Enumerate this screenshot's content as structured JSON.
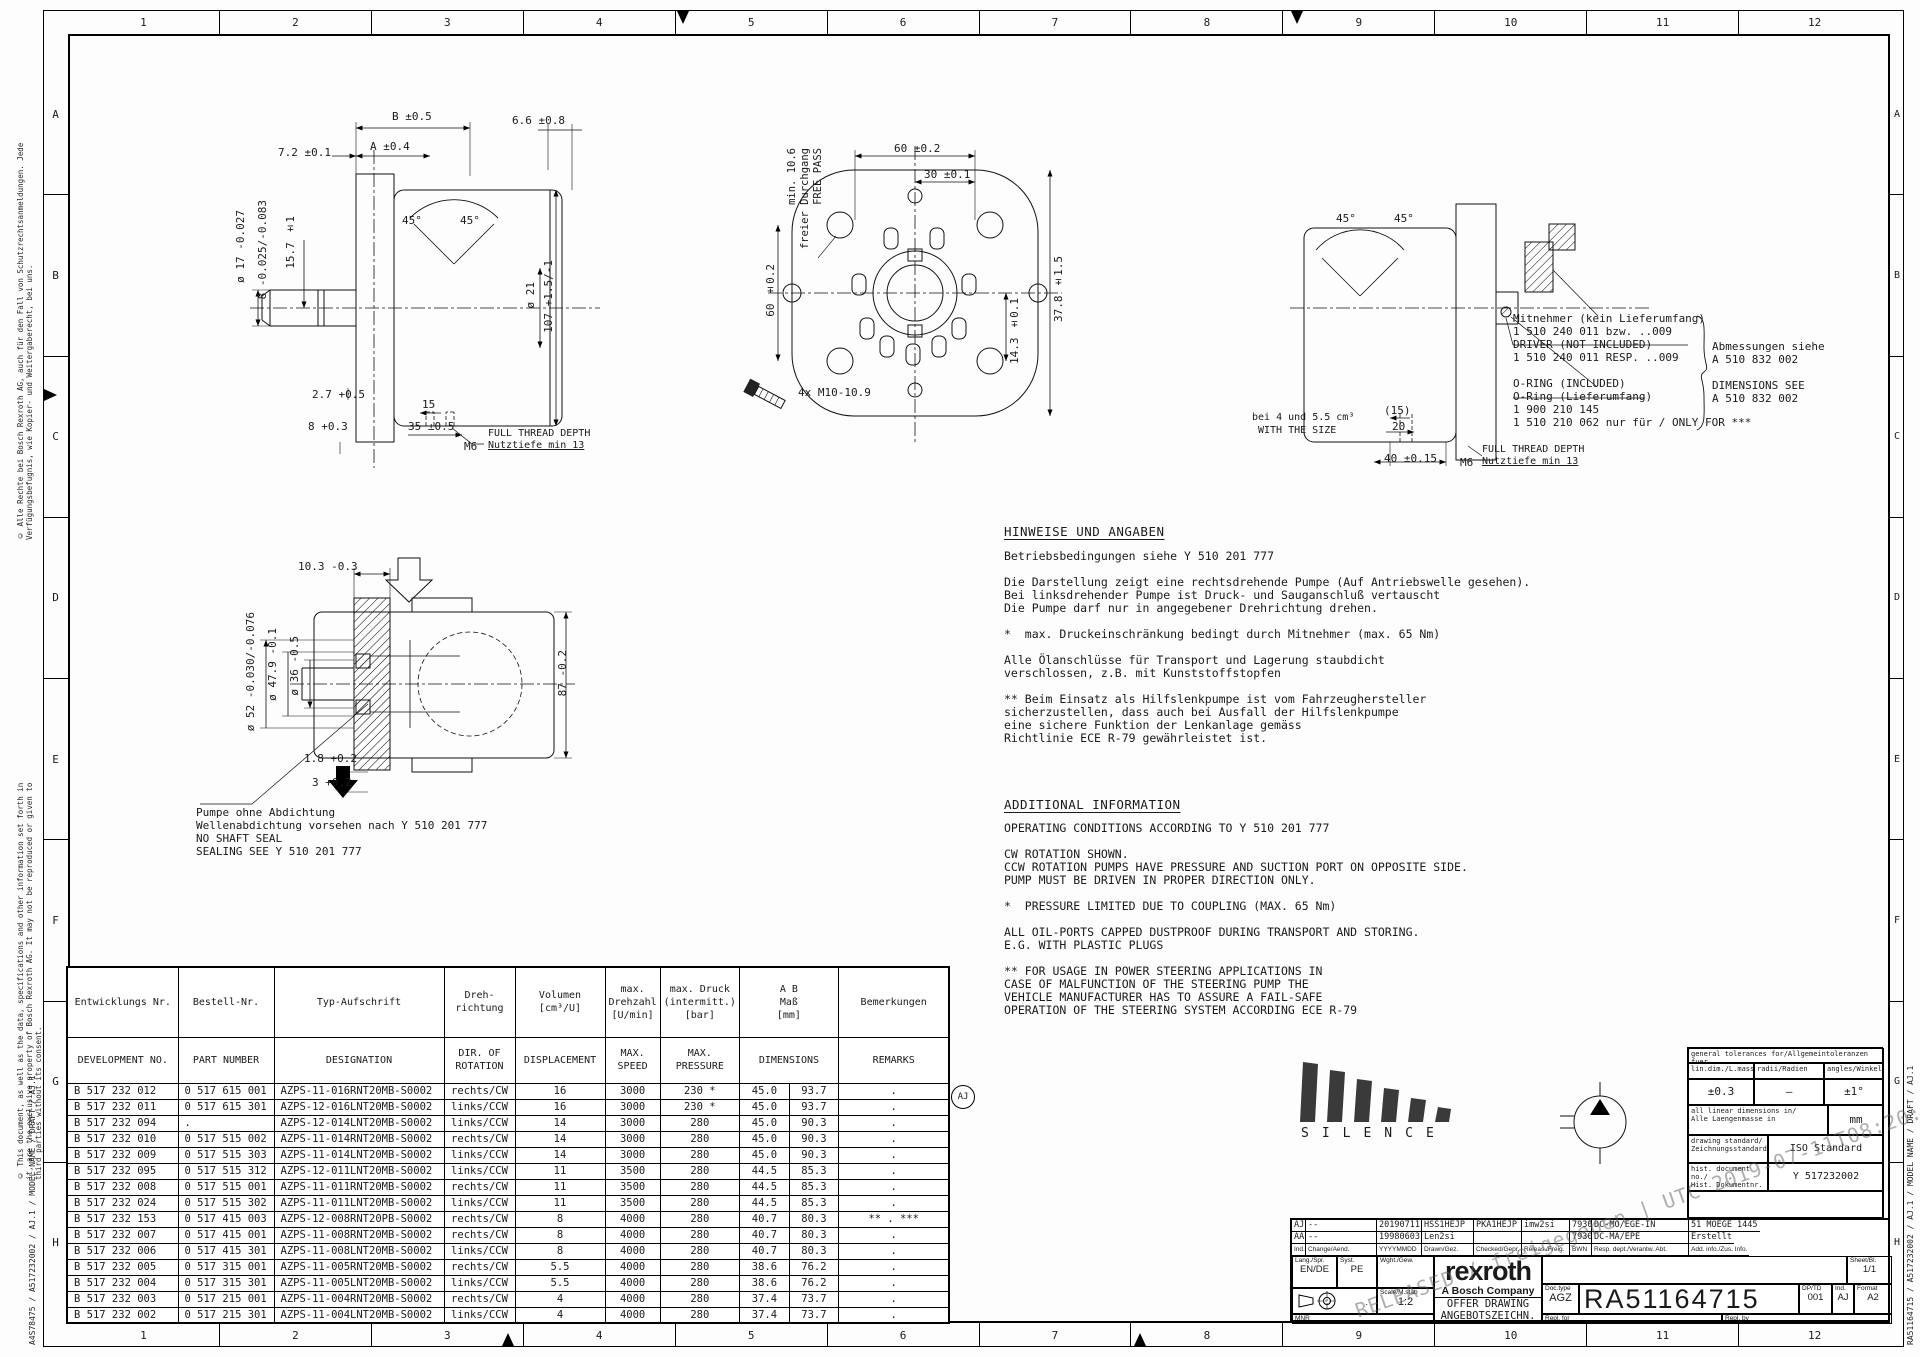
{
  "frame": {
    "columns": [
      "1",
      "2",
      "3",
      "4",
      "5",
      "6",
      "7",
      "8",
      "9",
      "10",
      "11",
      "12"
    ],
    "rows": [
      "A",
      "B",
      "C",
      "D",
      "E",
      "F",
      "G",
      "H"
    ]
  },
  "margin": {
    "copyright_de": "© Alle Rechte bei Bosch Rexroth AG, auch für den Fall von Schutzrechtsanmeldungen. Jede Verfügungsbefugnis, wie Kopier- und Weitergaberecht, bei uns.",
    "copyright_en": "© This document, as well as the data, specifications and other information set forth in it, are the exclusive property of Bosch Rexroth AG. It may not be reproduced or given to third parties without its consent.",
    "left_code": "A4S78475 / A517232002 / AJ.1 / MODEL NAME / DRAFT / AJ.1",
    "right_code": "RA51164715 / A517232002 / AJ.1 / MODEL NAME / DRAFT / AJ.1"
  },
  "dims": {
    "v1_72": "7.2 ±0.1",
    "v1_b": "B ±0.5",
    "v1_66": "6.6 ±0.8",
    "v1_a": "A ±0.4",
    "v1_d17": "ø 17 -0.027",
    "v1_8tol": "8 -0.025/-0.083",
    "v1_157": "15.7 ±1",
    "v1_45a": "45°",
    "v1_45b": "45°",
    "v1_d21": "ø 21",
    "v1_107": "107 +1.5/-1",
    "v1_27": "2.7 +0.5",
    "v1_8": "8 +0.3",
    "v1_15": "15",
    "v1_35": "35 ±0.5",
    "v1_m6": "M6",
    "v1_thread_en": "FULL THREAD DEPTH",
    "v1_thread_de": "Nutztiefe min 13",
    "v2_free1": "min. 10.6",
    "v2_free2": "freier Durchgang",
    "v2_free3": "FREE PASS",
    "v2_60t": "60 ±0.2",
    "v2_30": "30 ±0.1",
    "v2_378": "37.8 ±1.5",
    "v2_60l": "60 ±0.2",
    "v2_143": "14.3 ±0.1",
    "v2_screws": "4x M10-10.9",
    "v3_45a": "45°",
    "v3_45b": "45°",
    "v3_size1": "bei 4 und 5.5 cm³",
    "v3_size2": "WITH THE SIZE",
    "v3_15": "(15)",
    "v3_20": "20",
    "v3_40": "40 ±0.15",
    "v3_m6": "M6",
    "v3_thread_en": "FULL THREAD DEPTH",
    "v3_thread_de": "Nutztiefe min 13",
    "v4_103": "10.3 -0.3",
    "v4_d52": "ø 52 -0.030/-0.076",
    "v4_d479": "ø 47.9 -0.1",
    "v4_d36": "ø 36 -0.5",
    "v4_87": "87 -0.2",
    "v4_18": "1.8 +0.2",
    "v4_3": "3 +0.2"
  },
  "notes": {
    "driver_block": [
      "Mitnehmer (kein Lieferumfang)",
      "1 510 240 011 bzw. ..009",
      "DRIVER (NOT INCLUDED)",
      "1 510 240 011 RESP. ..009",
      "",
      "O-RING (INCLUDED)",
      "O-Ring (Lieferumfang)",
      "1 900 210 145",
      "1 510 210 062 nur für / ONLY FOR ***"
    ],
    "dimensions_block": [
      "Abmessungen siehe",
      "A 510 832 002",
      "",
      "DIMENSIONS SEE",
      "A 510 832 002"
    ],
    "seal_block": [
      "Pumpe ohne Abdichtung",
      "Wellenabdichtung vorsehen nach Y 510 201 777",
      "NO SHAFT SEAL",
      "SEALING SEE Y 510 201 777"
    ],
    "hinweise_heading": "HINWEISE UND ANGABEN",
    "hinweise_lines": [
      "Betriebsbedingungen siehe Y 510 201 777",
      "",
      "Die Darstellung zeigt eine rechtsdrehende Pumpe (Auf Antriebswelle gesehen).",
      "Bei linksdrehender Pumpe ist Druck- und Sauganschluß vertauscht",
      "Die Pumpe darf nur in angegebener Drehrichtung drehen.",
      "",
      "*  max. Druckeinschränkung bedingt durch Mitnehmer (max. 65 Nm)",
      "",
      "Alle Ölanschlüsse für Transport und Lagerung staubdicht",
      "verschlossen, z.B. mit Kunststoffstopfen",
      "",
      "** Beim Einsatz als Hilfslenkpumpe ist vom Fahrzeughersteller",
      "sicherzustellen, dass auch bei Ausfall der Hilfslenkpumpe",
      "eine sichere Funktion der Lenkanlage gemäss",
      "Richtlinie ECE R-79 gewährleistet ist."
    ],
    "additional_heading": "ADDITIONAL INFORMATION",
    "additional_lines": [
      "OPERATING CONDITIONS ACCORDING TO Y 510 201 777",
      "",
      "CW ROTATION SHOWN.",
      "CCW ROTATION PUMPS HAVE PRESSURE AND SUCTION PORT ON OPPOSITE SIDE.",
      "PUMP MUST BE DRIVEN IN PROPER DIRECTION ONLY.",
      "",
      "*  PRESSURE LIMITED DUE TO COUPLING (MAX. 65 Nm)",
      "",
      "ALL OIL-PORTS CAPPED DUSTPROOF DURING TRANSPORT AND STORING.",
      "E.G. WITH PLASTIC PLUGS",
      "",
      "** FOR USAGE IN POWER STEERING APPLICATIONS IN",
      "CASE OF MALFUNCTION OF THE STEERING PUMP THE",
      "VEHICLE MANUFACTURER HAS TO ASSURE A FAIL-SAFE",
      "OPERATION OF THE STEERING SYSTEM ACCORDING ECE R-79"
    ]
  },
  "parts_table": {
    "header_de": {
      "dev": "Entwicklungs Nr.",
      "part": "Bestell-Nr.",
      "desig": "Typ-Aufschrift",
      "rot": "Dreh-\nrichtung",
      "disp": "Volumen\n[cm³/U]",
      "speed": "max.\nDrehzahl\n[U/min]",
      "press": "max. Druck\n(intermitt.)\n[bar]",
      "dims": "A        B\nMaß\n[mm]",
      "rem": "Bemerkungen"
    },
    "header_en": {
      "dev": "DEVELOPMENT NO.",
      "part": "PART NUMBER",
      "desig": "DESIGNATION",
      "rot": "DIR. OF\nROTATION",
      "disp": "DISPLACEMENT",
      "speed": "MAX.\nSPEED",
      "press": "MAX.\nPRESSURE",
      "dims": "DIMENSIONS",
      "rem": "REMARKS"
    },
    "rows": [
      {
        "dev": "B 517 232 012",
        "part": "0 517 615 001",
        "desig": "AZPS-11-016RNT20MB-S0002",
        "rot": "rechts/CW",
        "disp": "16",
        "speed": "3000",
        "press": "230 *",
        "a": "45.0",
        "b": "93.7",
        "rem": "."
      },
      {
        "dev": "B 517 232 011",
        "part": "0 517 615 301",
        "desig": "AZPS-12-016LNT20MB-S0002",
        "rot": "links/CCW",
        "disp": "16",
        "speed": "3000",
        "press": "230 *",
        "a": "45.0",
        "b": "93.7",
        "rem": "."
      },
      {
        "dev": "B 517 232 094",
        "part": ".",
        "desig": "AZPS-12-014LNT20MB-S0002",
        "rot": "links/CCW",
        "disp": "14",
        "speed": "3000",
        "press": "280",
        "a": "45.0",
        "b": "90.3",
        "rem": "."
      },
      {
        "dev": "B 517 232 010",
        "part": "0 517 515 002",
        "desig": "AZPS-11-014RNT20MB-S0002",
        "rot": "rechts/CW",
        "disp": "14",
        "speed": "3000",
        "press": "280",
        "a": "45.0",
        "b": "90.3",
        "rem": "."
      },
      {
        "dev": "B 517 232 009",
        "part": "0 517 515 303",
        "desig": "AZPS-11-014LNT20MB-S0002",
        "rot": "links/CCW",
        "disp": "14",
        "speed": "3000",
        "press": "280",
        "a": "45.0",
        "b": "90.3",
        "rem": "."
      },
      {
        "dev": "B 517 232 095",
        "part": "0 517 515 312",
        "desig": "AZPS-12-011LNT20MB-S0002",
        "rot": "links/CCW",
        "disp": "11",
        "speed": "3500",
        "press": "280",
        "a": "44.5",
        "b": "85.3",
        "rem": "."
      },
      {
        "dev": "B 517 232 008",
        "part": "0 517 515 001",
        "desig": "AZPS-11-011RNT20MB-S0002",
        "rot": "rechts/CW",
        "disp": "11",
        "speed": "3500",
        "press": "280",
        "a": "44.5",
        "b": "85.3",
        "rem": "."
      },
      {
        "dev": "B 517 232 024",
        "part": "0 517 515 302",
        "desig": "AZPS-11-011LNT20MB-S0002",
        "rot": "links/CCW",
        "disp": "11",
        "speed": "3500",
        "press": "280",
        "a": "44.5",
        "b": "85.3",
        "rem": "."
      },
      {
        "dev": "B 517 232 153",
        "part": "0 517 415 003",
        "desig": "AZPS-12-008RNT20PB-S0002",
        "rot": "rechts/CW",
        "disp": "8",
        "speed": "4000",
        "press": "280",
        "a": "40.7",
        "b": "80.3",
        "rem": "** . ***"
      },
      {
        "dev": "B 517 232 007",
        "part": "0 517 415 001",
        "desig": "AZPS-11-008RNT20MB-S0002",
        "rot": "rechts/CW",
        "disp": "8",
        "speed": "4000",
        "press": "280",
        "a": "40.7",
        "b": "80.3",
        "rem": "."
      },
      {
        "dev": "B 517 232 006",
        "part": "0 517 415 301",
        "desig": "AZPS-11-008LNT20MB-S0002",
        "rot": "links/CCW",
        "disp": "8",
        "speed": "4000",
        "press": "280",
        "a": "40.7",
        "b": "80.3",
        "rem": "."
      },
      {
        "dev": "B 517 232 005",
        "part": "0 517 315 001",
        "desig": "AZPS-11-005RNT20MB-S0002",
        "rot": "rechts/CW",
        "disp": "5.5",
        "speed": "4000",
        "press": "280",
        "a": "38.6",
        "b": "76.2",
        "rem": "."
      },
      {
        "dev": "B 517 232 004",
        "part": "0 517 315 301",
        "desig": "AZPS-11-005LNT20MB-S0002",
        "rot": "links/CCW",
        "disp": "5.5",
        "speed": "4000",
        "press": "280",
        "a": "38.6",
        "b": "76.2",
        "rem": "."
      },
      {
        "dev": "B 517 232 003",
        "part": "0 517 215 001",
        "desig": "AZPS-11-004RNT20MB-S0002",
        "rot": "rechts/CW",
        "disp": "4",
        "speed": "4000",
        "press": "280",
        "a": "37.4",
        "b": "73.7",
        "rem": "."
      },
      {
        "dev": "B 517 232 002",
        "part": "0 517 215 301",
        "desig": "AZPS-11-004LNT20MB-S0002",
        "rot": "links/CCW",
        "disp": "4",
        "speed": "4000",
        "press": "280",
        "a": "37.4",
        "b": "73.7",
        "rem": "."
      }
    ]
  },
  "revision_mark": "AJ",
  "silence": "SILENCE",
  "tolerances": {
    "title": "general tolerances for/Allgemeintoleranzen fuer",
    "h_lin": "lin.dim./L.masse",
    "h_radii": "radii/Radien",
    "h_angles": "angles/Winkel",
    "v_lin": "±0.3",
    "v_radii": "–",
    "v_angles": "±1°",
    "lin_dims_label": "all linear dimensions in/\nAlle Laengenmasse in",
    "lin_dims_value": "mm",
    "std_label": "drawing standard/\nZeichnungsstandard",
    "std_value": "ISO Standard",
    "hist_label": "hist. document no./\nHist. Dokumentnr.",
    "hist_value": "Y 517232002"
  },
  "title_block": {
    "rev_rows": [
      {
        "ind": "AJ",
        "change": "--",
        "date": "20190711",
        "drawn": "HSS1HEJP",
        "checked": "PKA1HEJP",
        "released": "imw2si",
        "bwn": "7930",
        "dept": "DC-MO/EGE-IN",
        "info": "51 MOEGE 1445"
      },
      {
        "ind": "AA",
        "change": "--",
        "date": "19980603",
        "drawn": "Len2si",
        "checked": "",
        "released": "",
        "bwn": "7930",
        "dept": "DC-MA/EPE",
        "info": "Erstellt"
      }
    ],
    "rev_labels": {
      "ind": "Ind.",
      "change": "Change/Aend.",
      "date": "YYYYMMDD",
      "drawn": "Drawn/Gez.",
      "checked": "Checked/Gepr.",
      "released": "Releas./Freig.",
      "bwn": "BWN",
      "dept": "Resp. dept./Verantw. Abt.",
      "info": "Add. info./Zus. Info."
    },
    "lang_label": "Lang./Spr.",
    "lang_value": "EN/DE",
    "syst_label": "Syst.",
    "syst_value": "PE",
    "weight_label": "Wght./Gew.",
    "weight_value": "",
    "proj_value": ".",
    "scale_label": "Scale/M.stab",
    "scale_value": "1:2",
    "mnr_label": "MNR",
    "brand_logo": "rexroth",
    "brand_tagline": "A Bosch Company",
    "offer_line1": "OFFER DRAWING",
    "offer_line2": "ANGEBOTSZEICHN.",
    "title_en": "HYDRAULIC GEAR PUMP   AZPS",
    "title_de": "HYDROZAHNRADPUMPE",
    "sheet_label": "Sheet/Bl.",
    "sheet_value": "1/1",
    "doctype_label": "Doc.type",
    "doctype_value": "AGZ",
    "doc_number": "RA51164715",
    "dp_label": "DP/TD",
    "dp_value": "001",
    "ind_label": "Ind.",
    "ind_value": "AJ",
    "format_label": "Format",
    "format_value": "A2",
    "repl_for": "Repl. for",
    "repl_by": "Repl. by"
  },
  "watermark": "RELEASED / freigegeben | UTC 2019-07-11T08:20:35"
}
